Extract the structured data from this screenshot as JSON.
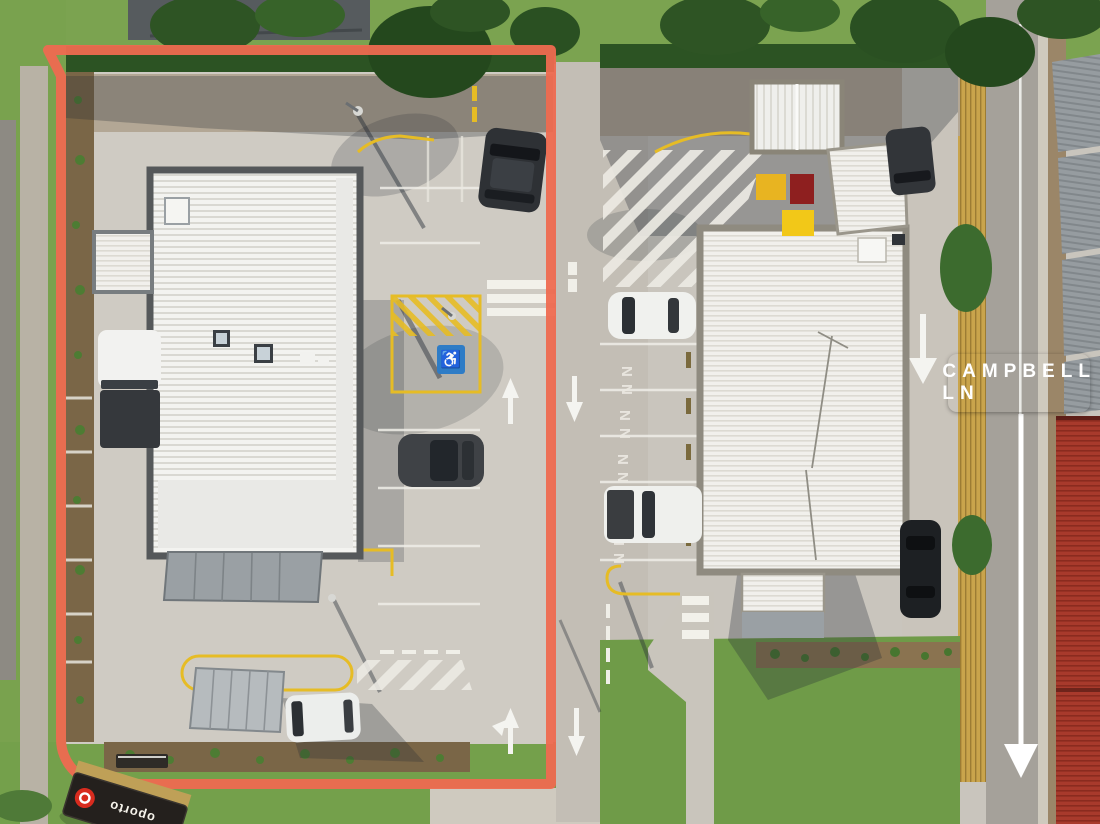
{
  "image_type": "aerial-site-photo",
  "street_sign": {
    "label": "CAMPBELL LN",
    "bg_color": "#1C2B3B",
    "text_color": "#FFFFFF"
  },
  "overlays": {
    "boundary_color": "#EE6A50",
    "boundary_target": "left-lot-outline",
    "road_arrow_color": "#FFFFFF",
    "road_arrow_direction": "down"
  },
  "pylon_sign": {
    "brand": "oporto",
    "logo_color": "#D82B1E",
    "panel_color": "#24201D"
  },
  "markings": {
    "disabled_symbol": "♿",
    "bay_letter": "N",
    "lane_line_color": "#E6BC25",
    "painted_arrow_color": "#F4F4F0"
  },
  "icons": {
    "disabled-parking-icon": "♿",
    "up-arrow-icon": "↑",
    "down-arrow-icon": "↓"
  }
}
